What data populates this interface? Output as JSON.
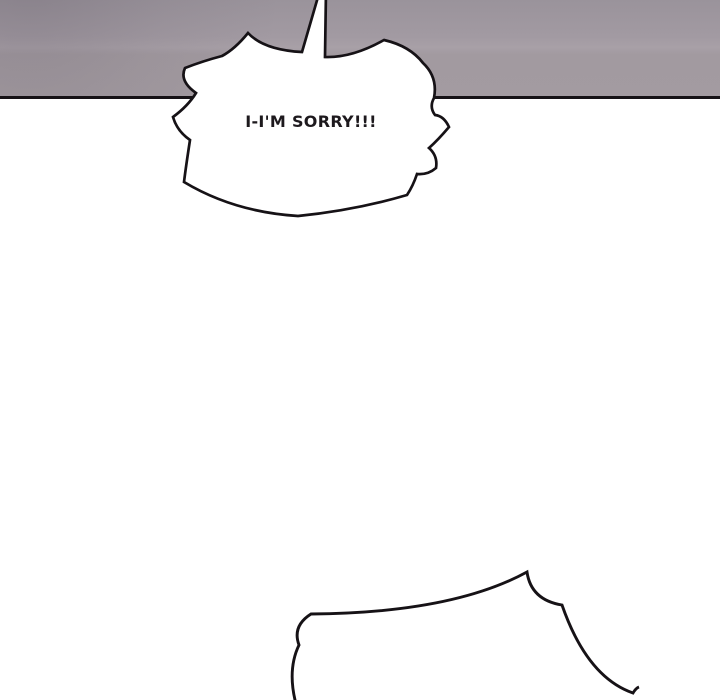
{
  "speech_bubble": {
    "text": "I-I'M SORRY!!!"
  },
  "colors": {
    "panel_white": "#ffffff",
    "wall_gray": "#a29aa2",
    "wall_gray_dark": "#9a939b",
    "wall_gray_seam_light": "#a8a0a7",
    "wall_gray_lower": "#a39ba1",
    "outline_ink": "#161216",
    "text_ink": "#1d191d"
  }
}
